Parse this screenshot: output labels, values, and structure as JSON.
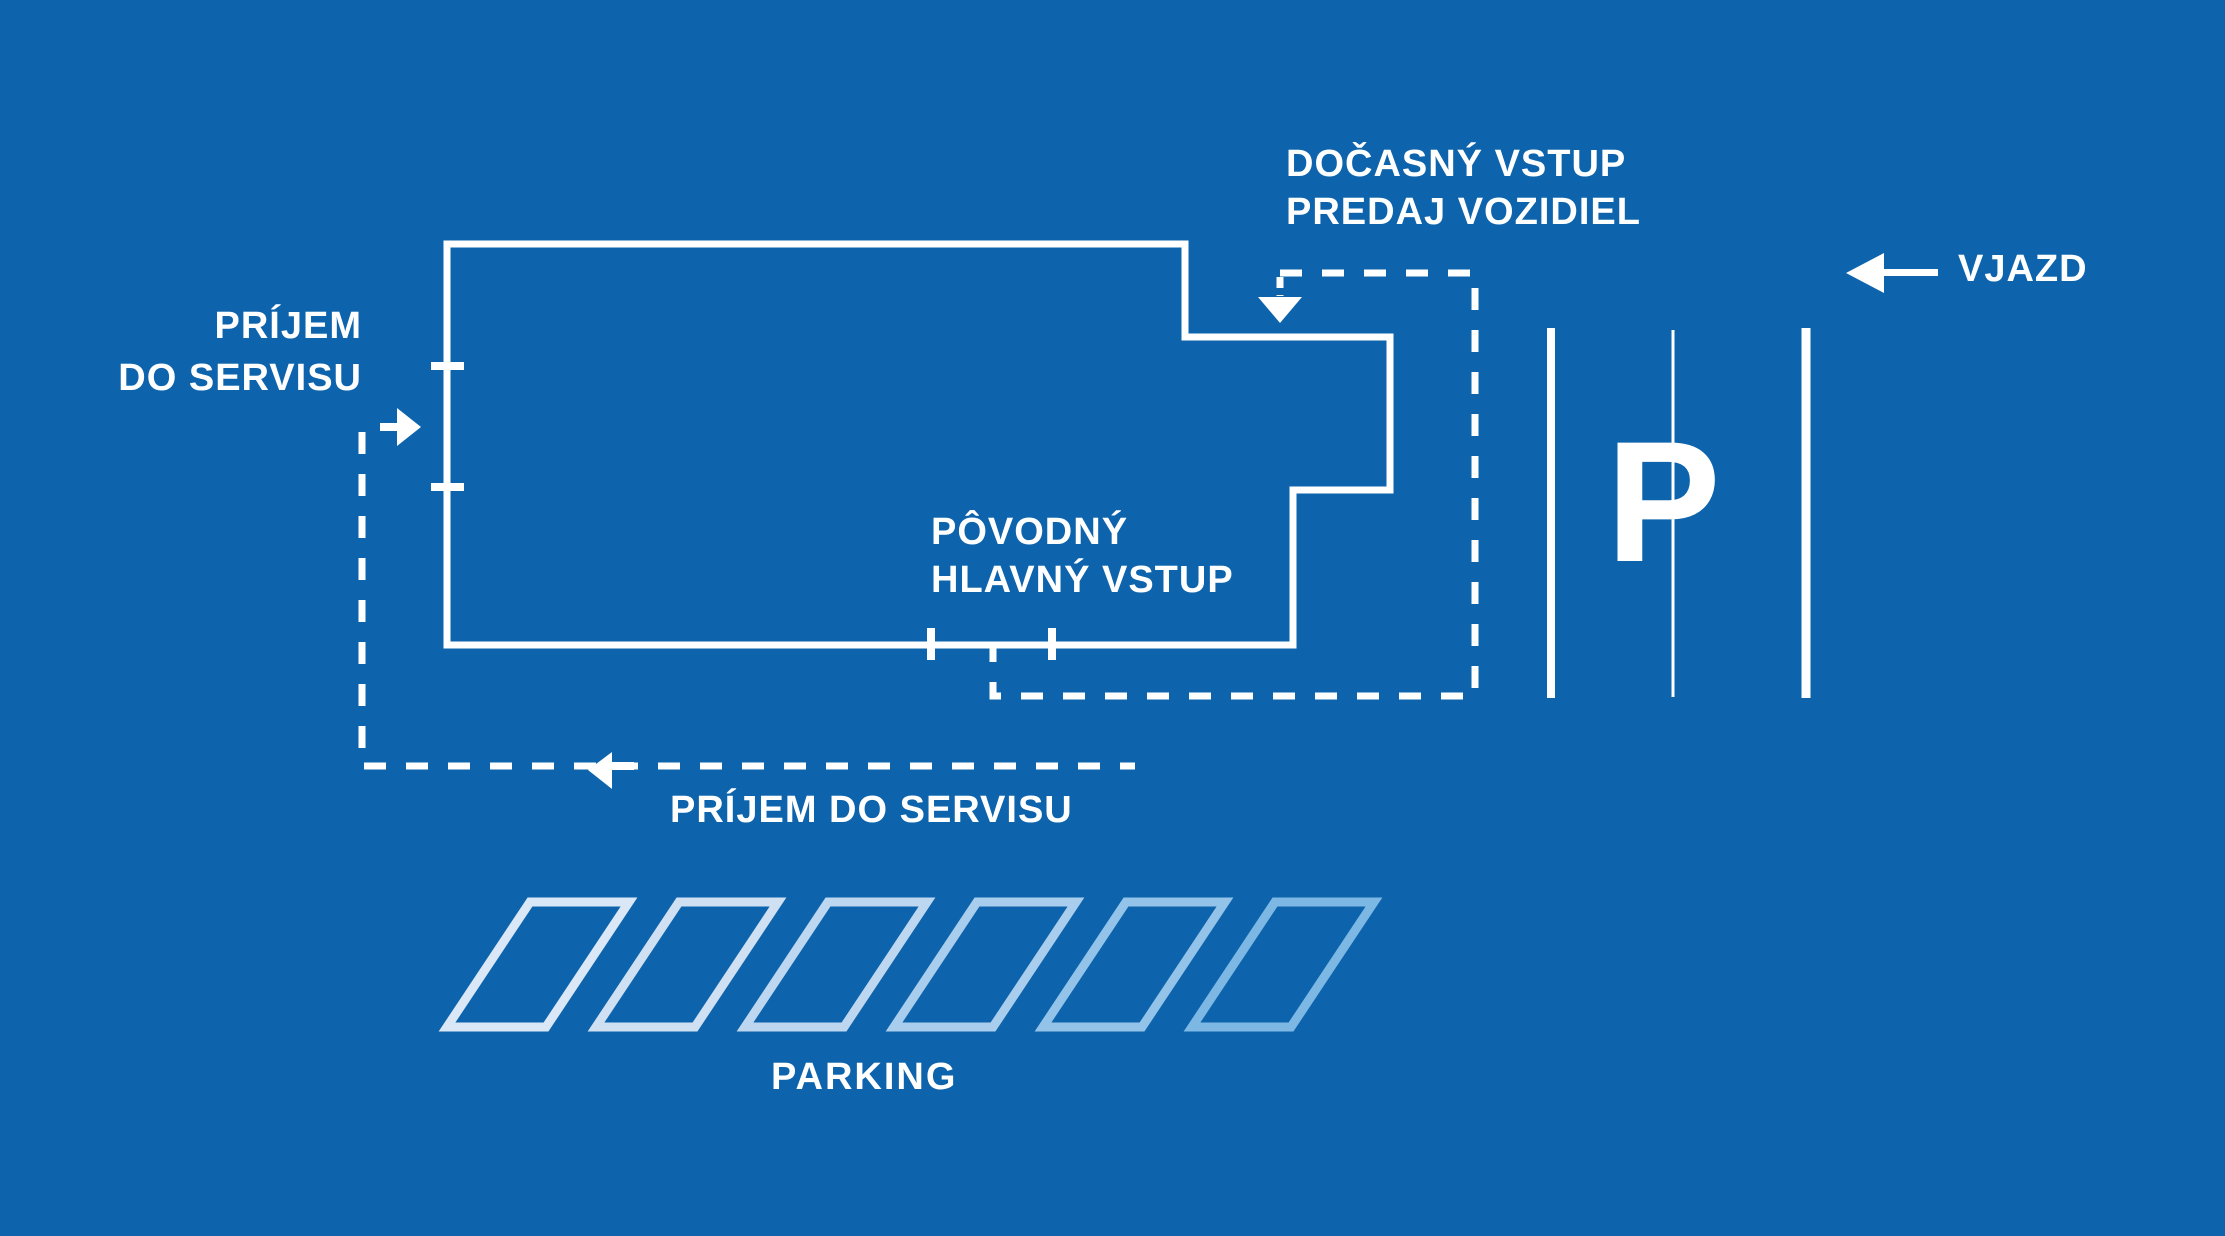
{
  "diagram": {
    "title": "dealership-site-access-plan",
    "colors": {
      "background": "#0d64ac",
      "line": "#ffffff",
      "parking_spot_colors": [
        "#d9e7f6",
        "#cfe0f3",
        "#bdd7f0",
        "#a9cdec",
        "#93c3e9",
        "#7db8e5"
      ]
    },
    "labels": {
      "temporary_entrance": {
        "line1": "DOČASNÝ VSTUP",
        "line2": "PREDAJ VOZIDIEL"
      },
      "entry": "VJAZD",
      "service_reception_left": {
        "line1": "PRÍJEM",
        "line2": "DO SERVISU"
      },
      "original_main_entrance": {
        "line1": "PÔVODNÝ",
        "line2": "HLAVNÝ VSTUP"
      },
      "service_reception_route": "PRÍJEM DO SERVISU",
      "parking": "PARKING",
      "parking_symbol": "P"
    },
    "icons": {
      "entry_arrow": "←",
      "service_in_arrow": "→",
      "service_route_arrow": "←",
      "temporary_entrance_arrow": "↓"
    }
  }
}
